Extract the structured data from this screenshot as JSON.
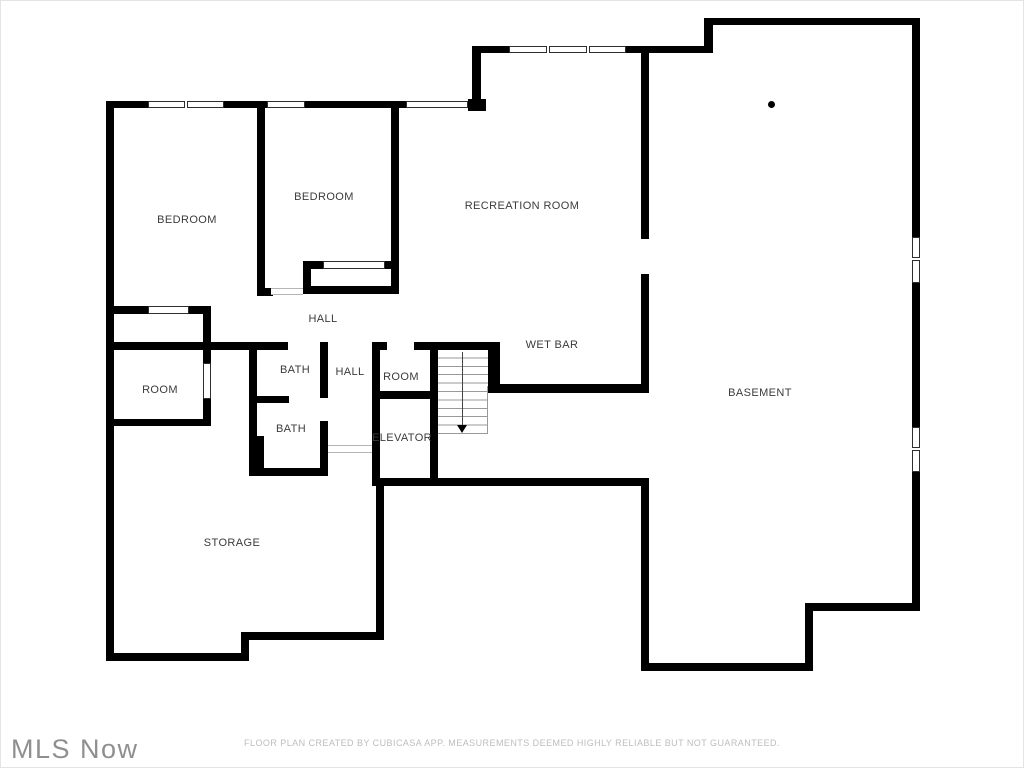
{
  "title": "Basement floor plan",
  "colors": {
    "wall": "#000000",
    "room_label": "#3b3b3b",
    "stair_tread": "#9a9a9a",
    "disclaimer_text": "#bdbdbd",
    "logo_text": "#8f8f8f"
  },
  "labels": [
    {
      "id": "bedroom-left",
      "text": "BEDROOM"
    },
    {
      "id": "bedroom-right",
      "text": "BEDROOM"
    },
    {
      "id": "recreation-room",
      "text": "RECREATION ROOM"
    },
    {
      "id": "hall-upper",
      "text": "HALL"
    },
    {
      "id": "wet-bar",
      "text": "WET BAR"
    },
    {
      "id": "bath-upper",
      "text": "BATH"
    },
    {
      "id": "hall-lower",
      "text": "HALL"
    },
    {
      "id": "room-small",
      "text": "ROOM"
    },
    {
      "id": "room-left",
      "text": "ROOM"
    },
    {
      "id": "basement",
      "text": "BASEMENT"
    },
    {
      "id": "bath-lower",
      "text": "BATH"
    },
    {
      "id": "elevator",
      "text": "ELEVATOR"
    },
    {
      "id": "storage",
      "text": "STORAGE"
    }
  ],
  "footer": {
    "logo": "MLS Now",
    "disclaimer": "FLOOR PLAN CREATED BY CUBICASA APP. MEASUREMENTS DEEMED HIGHLY RELIABLE BUT NOT GUARANTEED."
  }
}
